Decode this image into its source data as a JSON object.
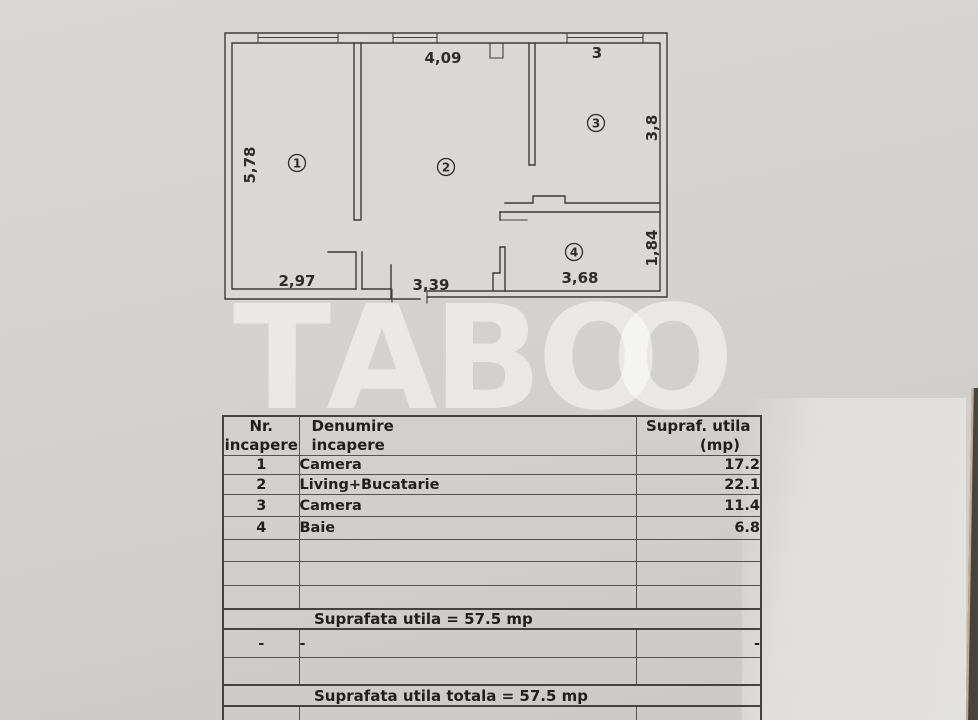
{
  "plan": {
    "rooms": {
      "r1": "1",
      "r2": "2",
      "r3": "3",
      "r4": "4"
    },
    "dims": {
      "top_room2": "4,09",
      "top_room3": "3",
      "left_room1": "5,78",
      "right_room3": "3,8",
      "right_room4": "1,84",
      "bottom_room1": "2,97",
      "bottom_room2": "3,39",
      "bottom_room4": "3,68"
    }
  },
  "watermark": {
    "letters": [
      "T",
      "A",
      "B",
      "O",
      "O"
    ]
  },
  "table": {
    "header": {
      "col1_line1": "Nr.",
      "col1_line2": "incapere",
      "col2_line1": "Denumire",
      "col2_line2": "incapere",
      "col3_line1": "Supraf. utila",
      "col3_line2": "(mp)"
    },
    "rows": [
      {
        "nr": "1",
        "name": "Camera",
        "area": "17.2"
      },
      {
        "nr": "2",
        "name": "Living+Bucatarie",
        "area": "22.1"
      },
      {
        "nr": "3",
        "name": "Camera",
        "area": "11.4"
      },
      {
        "nr": "4",
        "name": "Baie",
        "area": "6.8"
      }
    ],
    "summary_utila": "Suprafata utila = 57.5 mp",
    "dash_row": {
      "nr": "-",
      "name": "-",
      "area": "-"
    },
    "summary_totala": "Suprafata utila totala = 57.5 mp"
  },
  "colors": {
    "paper": "#d5d3d0",
    "paper_bright": "#e3e1de",
    "plan_line": "#3c3b38",
    "table_border": "#55524d",
    "text": "#201f1d",
    "watermark": "#e8e6e3",
    "photo_edge_dark": "#46443c",
    "photo_edge_warm": "#c9a98b"
  }
}
